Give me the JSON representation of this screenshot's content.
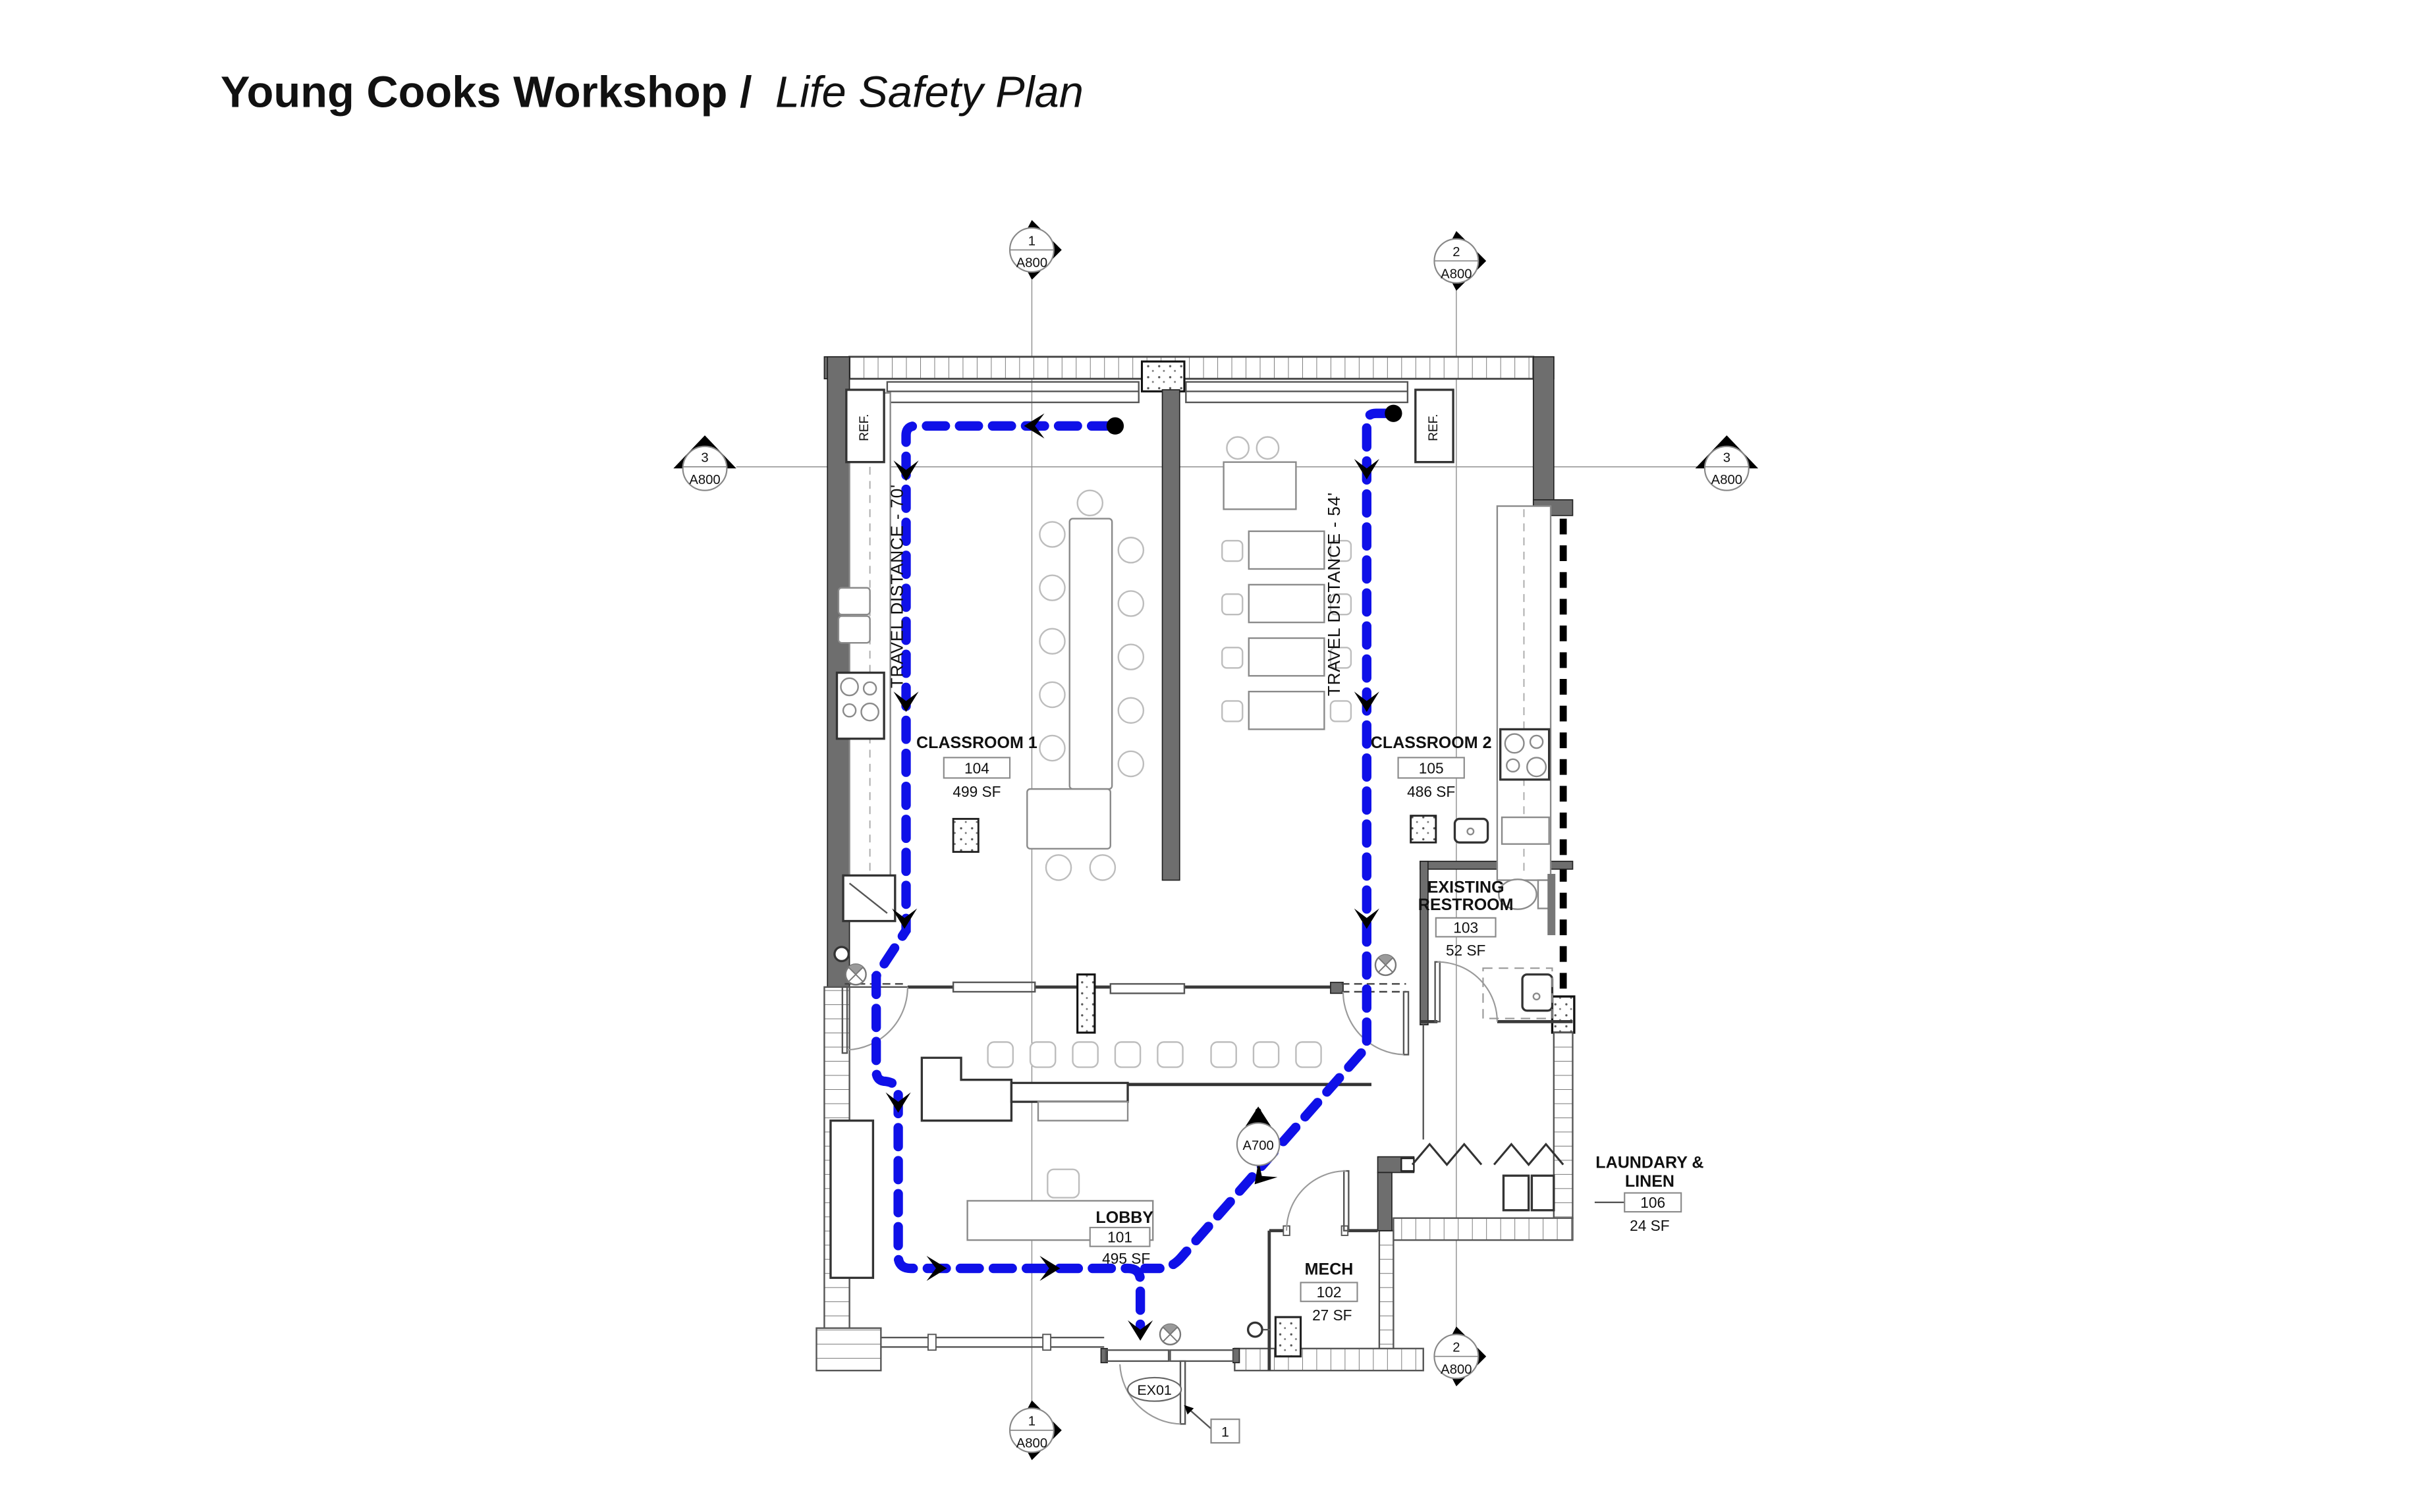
{
  "page_title": {
    "project": "Young Cooks Workshop /",
    "document": "Life Safety Plan"
  },
  "colors": {
    "egress_path": "#0f10e8",
    "title_text": "#1b2e38",
    "wall_fill": "#6e6e6e"
  },
  "rooms": {
    "classroom1": {
      "name": "CLASSROOM 1",
      "number": "104",
      "area": "499 SF"
    },
    "classroom2": {
      "name": "CLASSROOM 2",
      "number": "105",
      "area": "486 SF"
    },
    "restroom": {
      "name_line1": "EXISTING",
      "name_line2": "RESTROOM",
      "number": "103",
      "area": "52 SF"
    },
    "lobby": {
      "name": "LOBBY",
      "number": "101",
      "area": "495 SF"
    },
    "mech": {
      "name": "MECH",
      "number": "102",
      "area": "27 SF"
    },
    "laundry": {
      "name_line1": "LAUNDARY &",
      "name_line2": "LINEN",
      "number": "106",
      "area": "24 SF"
    }
  },
  "egress": {
    "travel_distance_classroom1": "TRAVEL DISTANCE - 70'",
    "travel_distance_classroom2": "TRAVEL DISTANCE - 54'"
  },
  "markers": {
    "top_left": {
      "number": "1",
      "sheet": "A800"
    },
    "top_right": {
      "number": "2",
      "sheet": "A800"
    },
    "side_left": {
      "number": "3",
      "sheet": "A800"
    },
    "side_right": {
      "number": "3",
      "sheet": "A800"
    },
    "bottom_left": {
      "number": "1",
      "sheet": "A800"
    },
    "bottom_right": {
      "number": "2",
      "sheet": "A800"
    },
    "callout": {
      "number": "2",
      "sheet": "A700"
    }
  },
  "tags": {
    "exit_door": "EX01",
    "keynote_1": "1",
    "refrigerator": "REF."
  }
}
